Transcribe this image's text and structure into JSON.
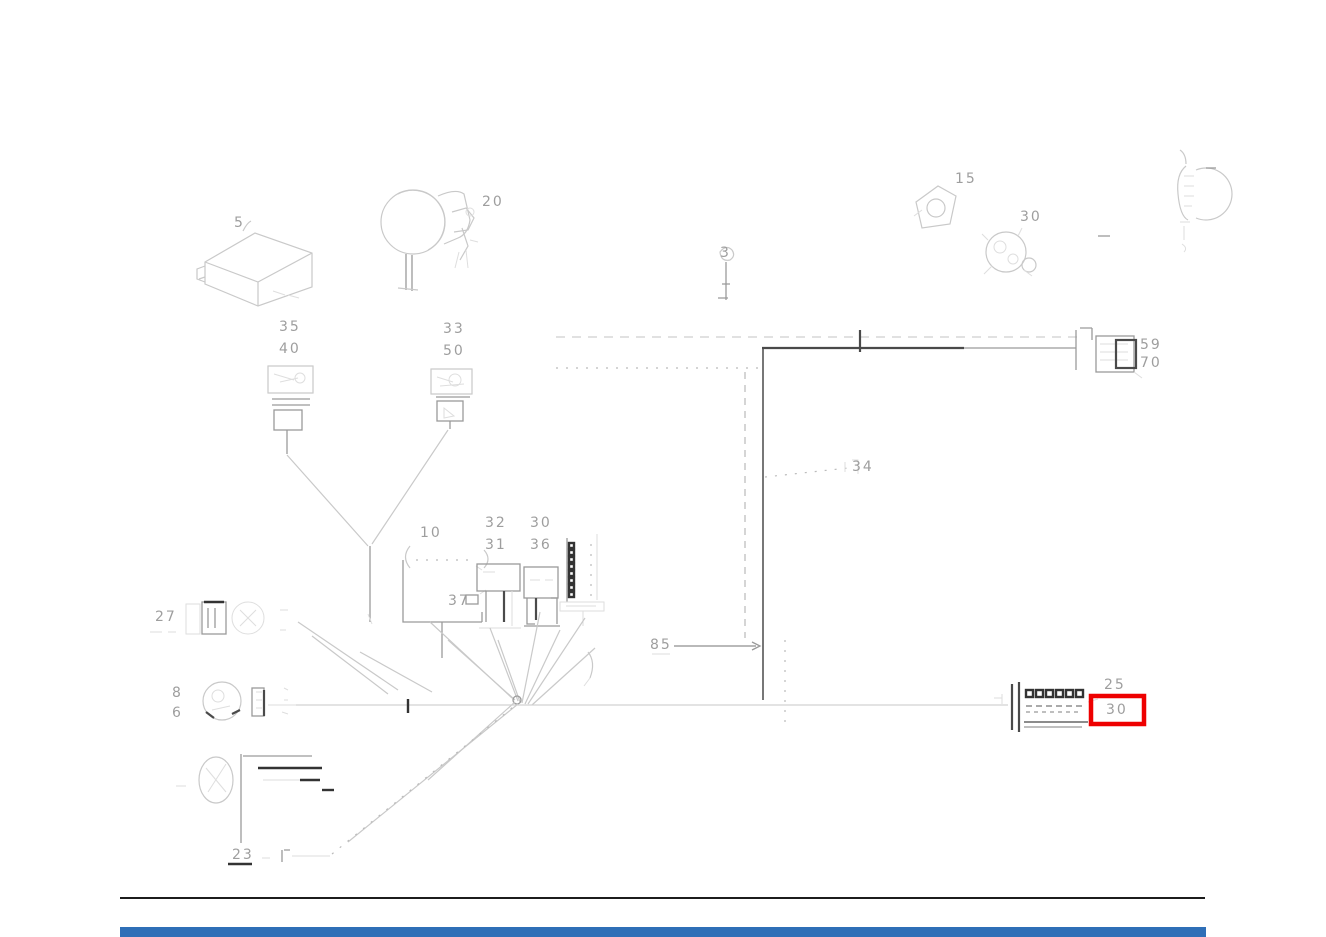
{
  "colors": {
    "highlight_red": "#ee0000",
    "footer_blue": "#2f6fb7",
    "line_light": "#c9c9c9",
    "line_dark": "#4a4a4a",
    "label_gray": "#9e9e9e"
  },
  "highlight": {
    "part_number": "30"
  },
  "labels": {
    "ecu": "5",
    "horn": "20",
    "lamp_top_right": "15",
    "flasher_top_right": "30",
    "stack_left_top": "35",
    "stack_left_bottom": "40",
    "stack_right_top": "33",
    "stack_right_bottom": "50",
    "part_top_center": "3",
    "conn_upper_right_top": "59",
    "conn_upper_right_bottom": "70",
    "branch_leader": "34",
    "cluster_bracket": "10",
    "cluster_box": "37",
    "relay_a_top": "32",
    "relay_a_bottom": "31",
    "relay_b_top": "30",
    "relay_b_bottom": "36",
    "conn_lower_left": "27",
    "conn_round_top": "8",
    "conn_round_bottom": "6",
    "trunk_leader": "85",
    "conn_lower_right": "25",
    "highlighted_part": "30",
    "bottom_leader": "23"
  }
}
